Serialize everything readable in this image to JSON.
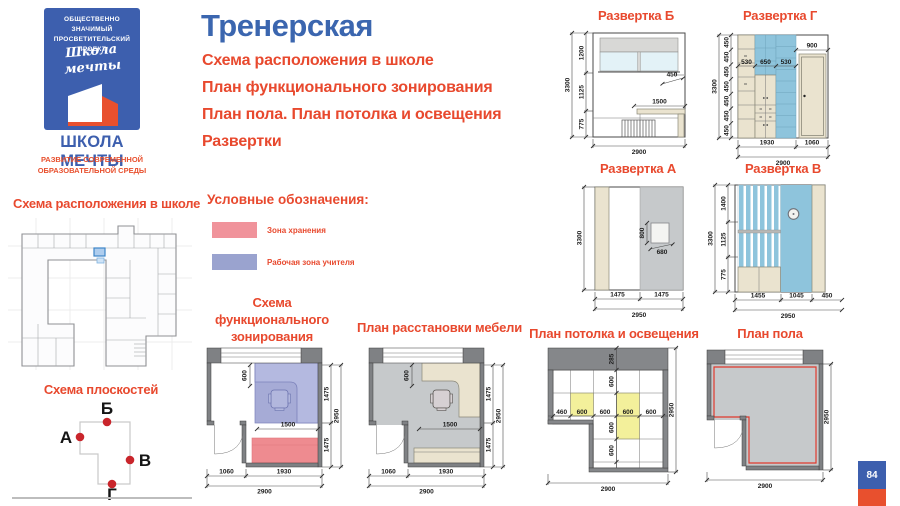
{
  "page": {
    "badge_number": "84"
  },
  "logo": {
    "badge_line1": "ОБЩЕСТВЕННО ЗНАЧИМЫЙ",
    "badge_line2": "ПРОСВЕТИТЕЛЬСКИЙ ПРОЕКТ",
    "script_word1": "Школа",
    "script_word2": "мечты",
    "org_name": "ШКОЛА МЕЧТЫ",
    "tagline_line1": "РАЗВИТИЕ СОВРЕМЕННОЙ",
    "tagline_line2": "ОБРАЗОВАТЕЛЬНОЙ СРЕДЫ"
  },
  "header": {
    "title": "Тренерская",
    "subtitle1": "Схема расположения в школе",
    "subtitle2": "План функционального зонирования",
    "subtitle3": "План пола. План потолка и освещения",
    "subtitle4": "Развертки"
  },
  "location": {
    "title": "Схема расположения в школе"
  },
  "planes": {
    "title": "Схема плоскостей",
    "top": "Б",
    "left": "А",
    "right": "В",
    "bottom": "Г"
  },
  "legend": {
    "title": "Условные обозначения:",
    "item1": "Зона хранения",
    "item1_color": "#f0939b",
    "item2": "Рабочая зона учителя",
    "item2_color": "#9aa3cf"
  },
  "zoning": {
    "title1": "Схема функционального",
    "title2": "зонирования",
    "dims": {
      "d600": "600",
      "d1500": "1500",
      "r1": "1475",
      "r2": "1475",
      "rt": "2950",
      "b1": "1060",
      "b2": "1930",
      "bt": "2900"
    }
  },
  "furniture": {
    "title": "План расстановки мебели",
    "dims": {
      "d600": "600",
      "d1500": "1500",
      "r1": "1475",
      "r2": "1475",
      "rt": "2950",
      "b1": "1060",
      "b2": "1930",
      "bt": "2900"
    }
  },
  "ceiling": {
    "title": "План потолка и освещения",
    "dims": {
      "soffit": "285",
      "c1": "460",
      "c2": "600",
      "c3": "600",
      "c4": "600",
      "c5": "600",
      "v1": "600",
      "v2": "600",
      "v3": "600",
      "rt": "2950",
      "bt": "2900"
    }
  },
  "floor": {
    "title": "План пола",
    "dims": {
      "rt": "2950",
      "bt": "2900"
    }
  },
  "elev_b": {
    "title": "Развертка Б",
    "dims": {
      "h1": "1200",
      "h2": "1125",
      "h3": "775",
      "ht": "3300",
      "sill": "450",
      "desk": "1500",
      "bt": "2900"
    }
  },
  "elev_g": {
    "title": "Развертка Г",
    "dims": {
      "s": "450",
      "ht": "3300",
      "w1": "530",
      "w2": "650",
      "w3": "530",
      "door": "900",
      "b1": "1930",
      "b2": "1060",
      "bt": "2900"
    }
  },
  "elev_a": {
    "title": "Развертка А",
    "dims": {
      "ht": "3300",
      "bh": "800",
      "bw": "680",
      "b1": "1475",
      "b2": "1475",
      "bt": "2950"
    }
  },
  "elev_v": {
    "title": "Развертка В",
    "dims": {
      "h1": "1400",
      "h2": "1125",
      "h3": "775",
      "ht": "3300",
      "b1": "1455",
      "b2": "1045",
      "b3": "450",
      "bt": "2950"
    }
  }
}
